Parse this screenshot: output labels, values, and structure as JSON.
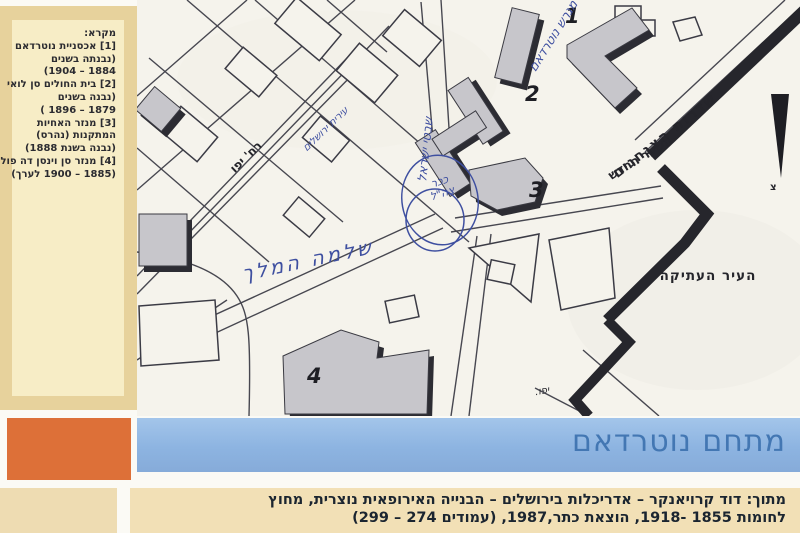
{
  "legend": {
    "lines": [
      "מקרא:",
      "[1] אכסניית נוטרדאם",
      "(נבנתה בשנים",
      "1884 – 1904)",
      "[2] בית החולים סן לואי",
      "(נבנה בשנים",
      "1879 – 1896 )",
      "[3] מנזר האחיות",
      "המתקנות (נהרס)",
      "(נבנה בשנת 1888)",
      "[4] מנזר סן וינסן דה פול",
      "(1885 – 1900 לערך)"
    ]
  },
  "map": {
    "labels": {
      "paratroopers_blvd": "שדרות הצנחנים",
      "new_gate": "השער החדש",
      "jaffa_road": "רח' יפו",
      "old_city": "העיר העתיקה",
      "jaffa_abbrev": "יפו.",
      "north_letter": "צ"
    },
    "numbers": {
      "n1": "1",
      "n2": "2",
      "n3": "3",
      "n4": "4"
    },
    "handwritten": {
      "notre_dame_lot": "מגרש נוטרדאם",
      "shivtei_israel_st": "שבטי ישראל",
      "tzahal_sq_line1": "ככר",
      "tzahal_sq_line2": "צה\"ל",
      "city_hall": "עירית ירושלים",
      "shlomo_hamelech_st": "שלמה המלך"
    }
  },
  "title_bar": {
    "title": "מתחם נוטרדאם"
  },
  "caption": {
    "line1": "מתוך: דוד קרויאנקר – אדריכלות בירושלים – הבנייה האירופאית נוצרית, מחוץ",
    "line2": "לחומות 1855 -1918, הוצאת כתר,1987, (עמודים 274 – 299)"
  },
  "colors": {
    "ink_blue": "#3e4fa0",
    "bar_blue": "#93bae5",
    "title_blue": "#4377b3",
    "orange": "#dd7038",
    "tan": "#e7d29c",
    "panel_cream": "#f7edc6"
  }
}
